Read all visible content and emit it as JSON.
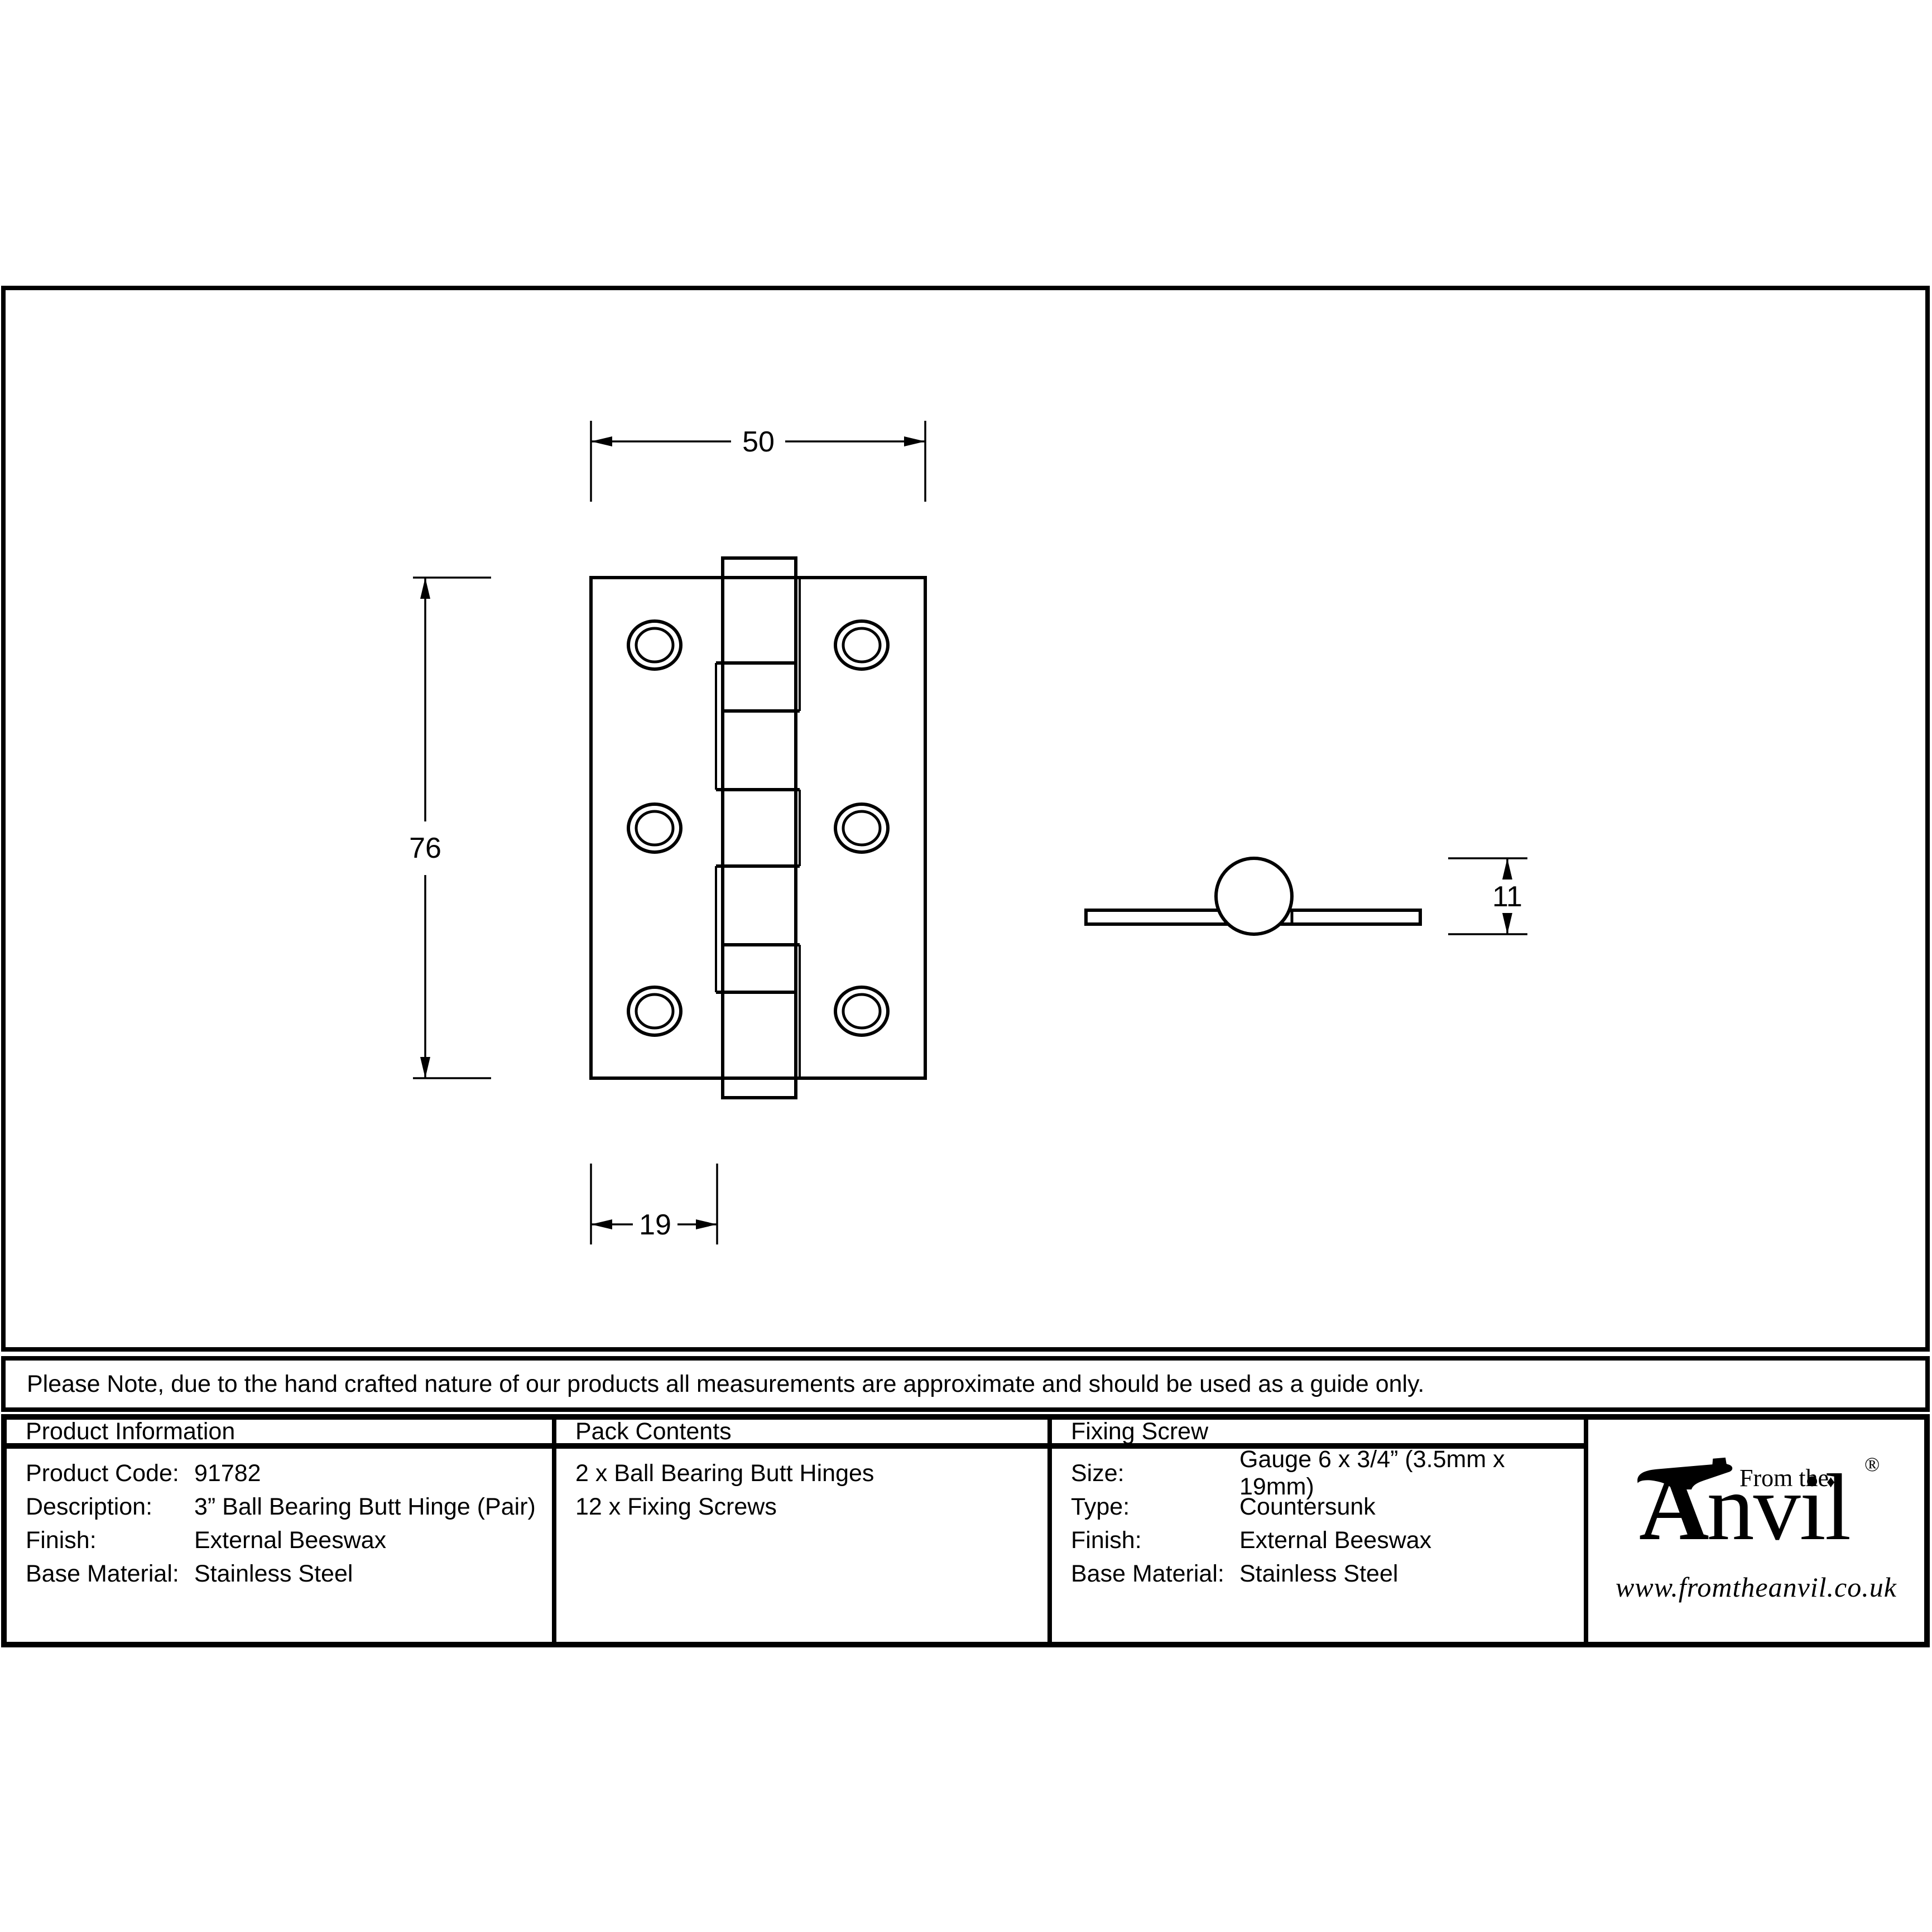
{
  "note": {
    "text": "Please Note, due to the hand crafted nature of our products all measurements are approximate and should be used as a guide only."
  },
  "drawing": {
    "front_view": {
      "width_label": "50",
      "height_label": "76",
      "leaf_label": "19"
    },
    "side_view": {
      "knuckle_label": "11"
    }
  },
  "table": {
    "product_information": {
      "title": "Product Information",
      "rows": [
        {
          "label": "Product Code:",
          "value": "91782"
        },
        {
          "label": "Description:",
          "value": "3” Ball Bearing Butt Hinge (Pair)"
        },
        {
          "label": "Finish:",
          "value": "External Beeswax"
        },
        {
          "label": "Base Material:",
          "value": "Stainless Steel"
        }
      ]
    },
    "pack_contents": {
      "title": "Pack Contents",
      "items": [
        "2 x Ball Bearing Butt Hinges",
        "12 x Fixing Screws"
      ]
    },
    "fixing_screw": {
      "title": "Fixing Screw",
      "rows": [
        {
          "label": "Size:",
          "value": "Gauge 6 x 3/4” (3.5mm x 19mm)"
        },
        {
          "label": "Type:",
          "value": "Countersunk"
        },
        {
          "label": "Finish:",
          "value": "External Beeswax"
        },
        {
          "label": "Base Material:",
          "value": "Stainless Steel"
        }
      ]
    }
  },
  "logo": {
    "prefix": "From the",
    "initial": "A",
    "name_rest": "nvil",
    "diamond": "♦",
    "registered": "®",
    "url": "www.fromtheanvil.co.uk"
  },
  "colors": {
    "ink": "#000000",
    "paper": "#ffffff"
  }
}
